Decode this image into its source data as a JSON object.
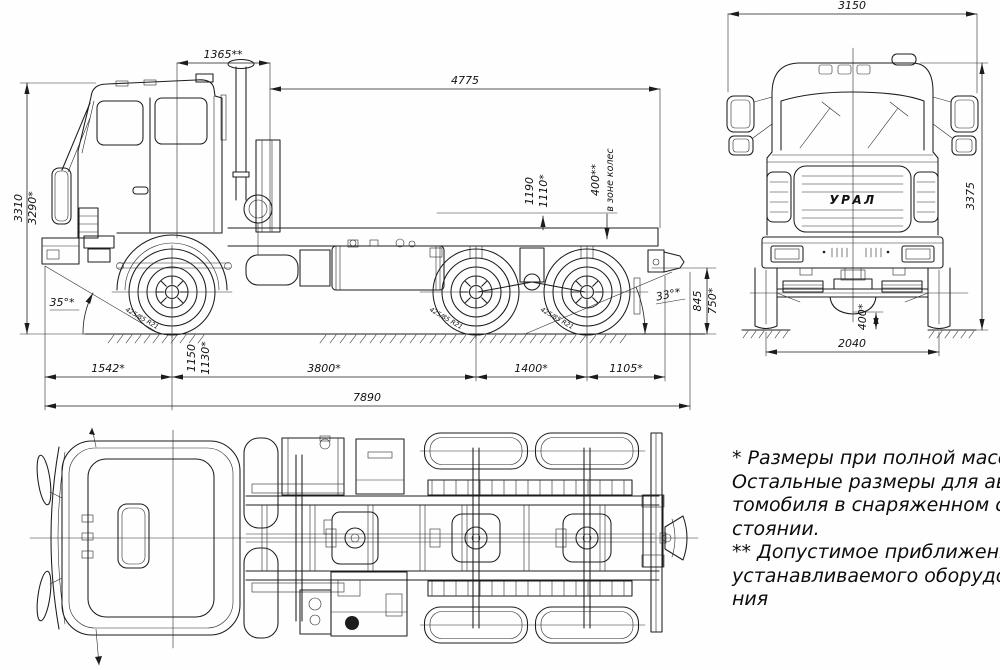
{
  "drawing": {
    "kind": "three-view dimensional drawing of Ural 6x6 truck chassis",
    "ink": "#1c1c1c",
    "background": "#fefefe"
  },
  "side_dims": {
    "cab_gap": "1365**",
    "frame_length": "4775",
    "height_max": "3310",
    "height_loaded": "3290*",
    "frame_h1": "1190",
    "frame_h2": "1110*",
    "wheel_zone_dim": "400**",
    "wheel_zone_text": "в зоне колес",
    "angle_front": "35°*",
    "angle_rear": "33°*",
    "rear_h1": "845",
    "rear_h2": "750*",
    "front_overhang": "1542*",
    "axle_h1": "1150",
    "axle_h2": "1130*",
    "wheelbase": "3800*",
    "bogie": "1400*",
    "rear_overhang": "1105*",
    "total_length": "7890",
    "tire": "425/85 R21"
  },
  "front_dims": {
    "width": "3150",
    "height": "3375",
    "track": "2040",
    "clearance": "400*",
    "logo": "УРАЛ"
  },
  "notes": {
    "block1": [
      "* Размеры при полной массе.",
      "Остальные размеры для ав-",
      "томобиля в снаряженном со-",
      "стоянии."
    ],
    "block2": [
      "** Допустимое приближение",
      "устанавливаемого оборудова-",
      "ния"
    ]
  }
}
